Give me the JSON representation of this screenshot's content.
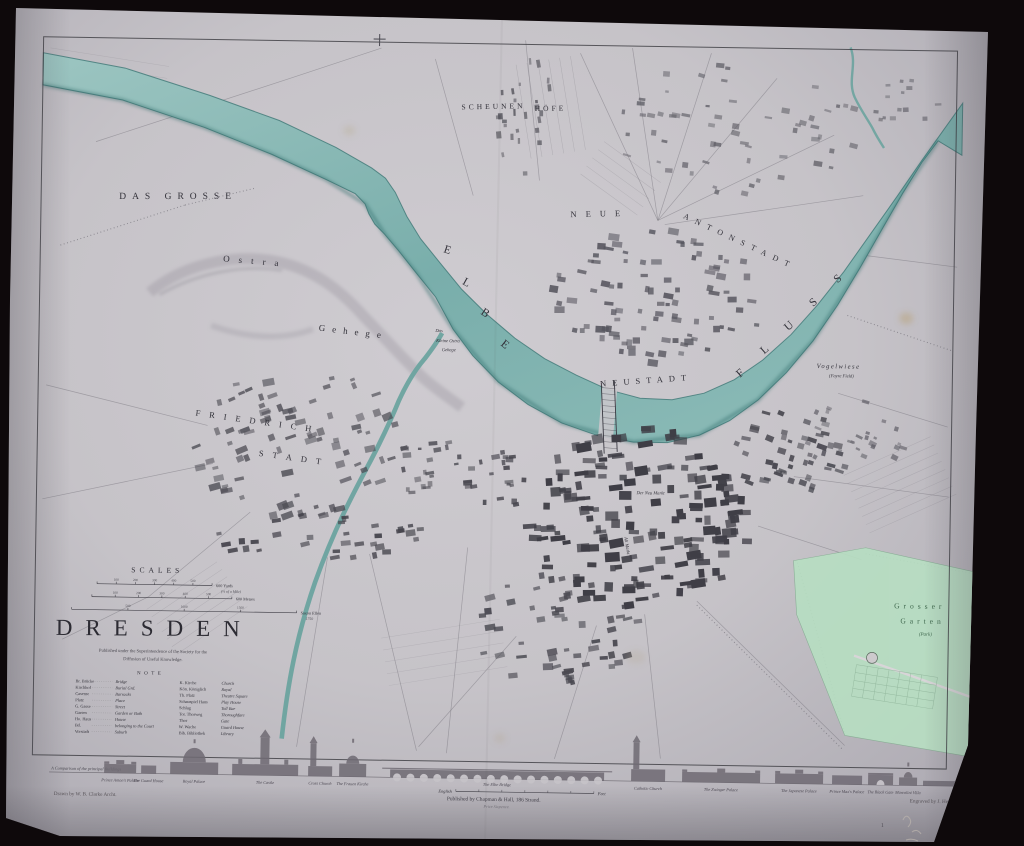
{
  "scene": {
    "backdrop": "#0e090b",
    "paper": "#c7c4c9",
    "ink": "#33323a",
    "river": "#7fb2ae",
    "river_deep": "#4f8b88",
    "park_green": "#b7dfc2",
    "park_ink": "#41694f"
  },
  "title_block": {
    "scales_title": "SCALES",
    "title": "DRESDEN",
    "subtitle": [
      "Published under the Superintendence of the Society for the",
      "Diffusion of Useful Knowledge."
    ],
    "scale_bars": [
      {
        "ticks": [
          "100",
          "200",
          "300",
          "400",
          "500"
        ],
        "end_label": "600 Yards",
        "note": "(⅓ of a Mile)"
      },
      {
        "ticks": [
          "100",
          "200",
          "300",
          "400",
          "500"
        ],
        "end_label": "600 Metres",
        "note": ""
      },
      {
        "ticks": [
          "500",
          "1000",
          "1500"
        ],
        "end_label": "Saxon Ellen",
        "note": "1750"
      }
    ]
  },
  "reference": {
    "title": "NOTE",
    "rows": [
      [
        "Br. Brücke",
        "Bridge",
        "K. Kirche",
        "Church"
      ],
      [
        "Kirchhof",
        "Burial Grd.",
        "Kön. Königlich",
        "Royal"
      ],
      [
        "Caserne",
        "Barracks",
        "Th. Platz",
        "Theatre Square"
      ],
      [
        "Platz",
        "Place",
        "Schauspiel Haus",
        "Play House"
      ],
      [
        "G. Gasse",
        "Street",
        "Schlag",
        "Toll Bar"
      ],
      [
        "Garten",
        "Garden or Bath",
        "Tor. Thorweg",
        "Thoroughfare"
      ],
      [
        "Ho. Haus",
        "House",
        "Thor",
        "Gate"
      ],
      [
        "Bd.",
        "belonging to the Court",
        "W. Wache",
        "Guard House"
      ],
      [
        "Vorstadt",
        "Suburb",
        "Bib. Bibliothek",
        "Library"
      ]
    ]
  },
  "map_labels": [
    {
      "t": "DAS GROSSE",
      "x": 175,
      "y": 204,
      "s": 9.5,
      "ls": 6,
      "r": -1
    },
    {
      "t": "Ostra",
      "x": 253,
      "y": 268,
      "s": 9,
      "ls": 9,
      "r": 4
    },
    {
      "t": "Gehege",
      "x": 352,
      "y": 337,
      "s": 9,
      "ls": 7,
      "r": 6
    },
    {
      "t": "Das",
      "x": 438,
      "y": 333,
      "s": 4.6,
      "i": 1
    },
    {
      "t": "Kleine Ostra",
      "x": 447,
      "y": 343,
      "s": 4.6,
      "i": 1
    },
    {
      "t": "Gehege",
      "x": 448,
      "y": 352,
      "s": 4.6,
      "i": 1
    },
    {
      "t": "SCHEUNEN",
      "x": 489,
      "y": 109,
      "s": 7.5,
      "ls": 3,
      "r": -2
    },
    {
      "t": "HÖFE",
      "x": 546,
      "y": 110,
      "s": 7.5,
      "ls": 3,
      "r": -2
    },
    {
      "t": "E",
      "x": 444,
      "y": 254,
      "s": 11.5,
      "r": 18
    },
    {
      "t": "L",
      "x": 463,
      "y": 286,
      "s": 11.5,
      "r": 28
    },
    {
      "t": "B",
      "x": 482,
      "y": 316,
      "s": 11.5,
      "r": 33
    },
    {
      "t": "E",
      "x": 502,
      "y": 347,
      "s": 11.5,
      "r": 38
    },
    {
      "t": "NEUSTADT",
      "x": 646,
      "y": 381,
      "s": 8.5,
      "ls": 6,
      "r": -5
    },
    {
      "t": "F",
      "x": 742,
      "y": 372,
      "s": 11.5,
      "r": -42
    },
    {
      "t": "L",
      "x": 766,
      "y": 348,
      "s": 11.5,
      "r": -42
    },
    {
      "t": "U",
      "x": 790,
      "y": 324,
      "s": 11.5,
      "r": -42
    },
    {
      "t": "S",
      "x": 814,
      "y": 300,
      "s": 11.5,
      "r": -42
    },
    {
      "t": "S",
      "x": 838,
      "y": 276,
      "s": 11.5,
      "r": -42
    },
    {
      "t": "FRIEDRICH",
      "x": 258,
      "y": 428,
      "s": 8.5,
      "ls": 9,
      "r": 7
    },
    {
      "t": "STADT",
      "x": 295,
      "y": 464,
      "s": 8.5,
      "ls": 9,
      "r": 7
    },
    {
      "t": "NEUE",
      "x": 597,
      "y": 215,
      "s": 8.5,
      "ls": 9,
      "r": -2
    },
    {
      "t": "ANTONSTADT",
      "x": 736,
      "y": 240,
      "s": 8,
      "ls": 7,
      "r": 24
    },
    {
      "t": "Vogelwiese",
      "x": 838,
      "y": 363,
      "s": 6.5,
      "ls": 1.5,
      "i": 1
    },
    {
      "t": "(Fayre Field)",
      "x": 841,
      "y": 372,
      "s": 4.6,
      "i": 1
    },
    {
      "t": "Grosser",
      "x": 923,
      "y": 602,
      "s": 7.5,
      "ls": 4,
      "c": "#41694f"
    },
    {
      "t": "Garten",
      "x": 926,
      "y": 617,
      "s": 7.5,
      "ls": 4,
      "c": "#41694f"
    },
    {
      "t": "(Park)",
      "x": 929,
      "y": 629,
      "s": 5,
      "i": 1,
      "c": "#41694f"
    },
    {
      "t": "Der Neu Markt",
      "x": 652,
      "y": 492,
      "s": 4.6,
      "i": 1
    },
    {
      "t": "Alt Markt",
      "x": 628,
      "y": 544,
      "s": 4.6,
      "i": 1,
      "r": 80
    },
    {
      "t": "1",
      "x": 889,
      "y": 821,
      "s": 6,
      "c": "#55525a"
    }
  ],
  "skyline": {
    "caption": "A Comparison of the principal Buildings",
    "bridge_scale": {
      "left": "English",
      "right": "Feet"
    },
    "buildings": [
      {
        "label": "Prince Anton's Palace",
        "type": "palace",
        "x": 110,
        "w": 32,
        "h": 9
      },
      {
        "label": "The Guard House",
        "type": "block",
        "x": 147,
        "w": 15,
        "h": 8
      },
      {
        "label": "Royal Palace",
        "type": "dome",
        "x": 176,
        "w": 48,
        "h": 12,
        "th": 20
      },
      {
        "label": "The Castle",
        "type": "castle",
        "x": 238,
        "w": 66,
        "h": 11,
        "th": 27
      },
      {
        "label": "Cross Church",
        "type": "church",
        "x": 314,
        "w": 24,
        "h": 10,
        "th": 23
      },
      {
        "label": "The Frauen Kirche",
        "type": "dome",
        "x": 345,
        "w": 27,
        "h": 13,
        "th": 22
      },
      {
        "label": "The Elbe Bridge",
        "type": "bridge",
        "x": 396,
        "w": 214,
        "h": 8
      },
      {
        "label": "Catholic Church",
        "type": "church",
        "x": 637,
        "w": 34,
        "h": 12,
        "th": 27
      },
      {
        "label": "The Zwinger Palace",
        "type": "palace",
        "x": 688,
        "w": 78,
        "h": 10
      },
      {
        "label": "The Japanese Palace",
        "type": "palace",
        "x": 781,
        "w": 48,
        "h": 10
      },
      {
        "label": "Prince Max's Palace",
        "type": "block",
        "x": 838,
        "w": 30,
        "h": 9
      },
      {
        "label": "The Black Gate",
        "type": "gate",
        "x": 874,
        "w": 25,
        "h": 10
      },
      {
        "label": "Marcolini Villa",
        "type": "dome",
        "x": 905,
        "w": 18,
        "h": 8,
        "th": 12
      },
      {
        "label": "",
        "type": "block",
        "x": 929,
        "w": 38,
        "h": 5
      }
    ]
  },
  "imprint": {
    "drawn_by": "Drawn by W. B. Clarke Archt.",
    "published": "Published by Chapman & Hall, 186 Strand.",
    "price": "Price Sixpence.",
    "engraved_by": "Engraved by J. Henshall."
  }
}
